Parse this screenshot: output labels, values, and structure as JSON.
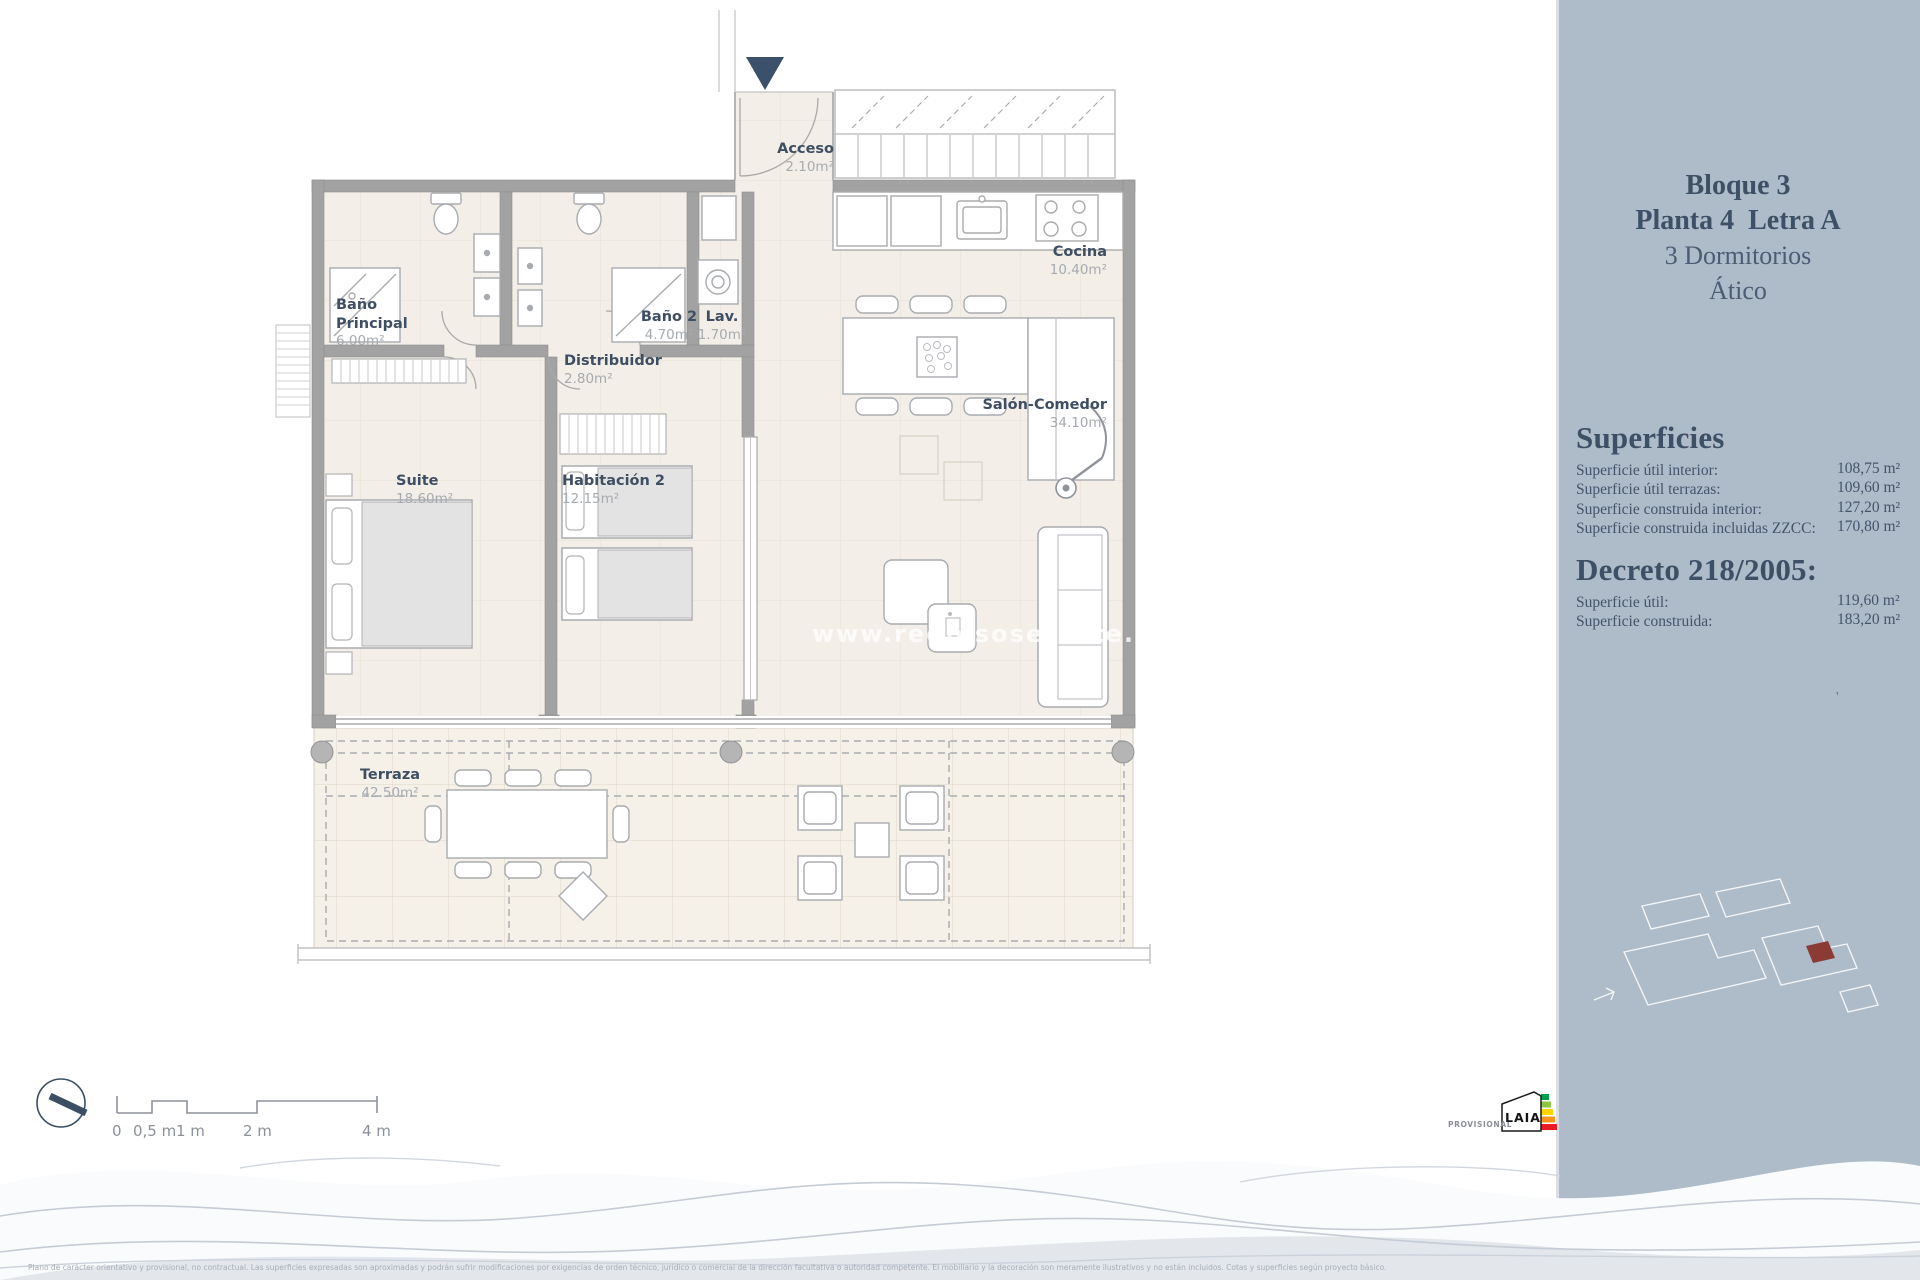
{
  "panel": {
    "line1": "Bloque 3",
    "line2": "Planta 4  Letra A",
    "line3": "3 Dormitorios",
    "line4": "Ático",
    "superficies_heading": "Superficies",
    "sup_rows": [
      {
        "label": "Superficie útil interior:",
        "value": "108,75 m²"
      },
      {
        "label": "Superficie útil terrazas:",
        "value": "109,60 m²"
      },
      {
        "label": "Superficie construida interior:",
        "value": "127,20 m²"
      },
      {
        "label": "Superficie construida incluidas ZZCC:",
        "value": "170,80 m²"
      }
    ],
    "decreto_heading": "Decreto 218/2005:",
    "dec_rows": [
      {
        "label": "Superficie útil:",
        "value": "119,60 m²"
      },
      {
        "label": "Superficie construida:",
        "value": "183,20 m²"
      }
    ],
    "stray_mark": "'"
  },
  "rooms": {
    "acceso": {
      "name": "Acceso",
      "area": "2.10m²"
    },
    "banyo_principal": {
      "name": "Baño Principal",
      "area": "6.00m²"
    },
    "banyo2": {
      "name": "Baño 2",
      "area": "4.70m²"
    },
    "lav": {
      "name": "Lav.",
      "area": "1.70m²"
    },
    "distribuidor": {
      "name": "Distribuidor",
      "area": "2.80m²"
    },
    "cocina": {
      "name": "Cocina",
      "area": "10.40m²"
    },
    "salon": {
      "name": "Salón-Comedor",
      "area": "34.10m²"
    },
    "suite": {
      "name": "Suite",
      "area": "18.60m²"
    },
    "habitacion2": {
      "name": "Habitación 2",
      "area": "12.15m²"
    },
    "terraza": {
      "name": "Terraza",
      "area": "42.50m²"
    }
  },
  "watermark": "www.redpisosestate.com",
  "scale": {
    "labels": [
      "0",
      "0,5 m",
      "1 m",
      "2 m",
      "4 m"
    ]
  },
  "footer": {
    "provisional": "PROVISIONAL",
    "logo_text": "LAIA",
    "disclaimer": "Plano de carácter orientativo y provisional, no contractual. Las superficies expresadas son aproximadas y podrán sufrir modificaciones por exigencias de orden técnico, jurídico o comercial de la dirección facultativa o autoridad competente. El mobiliario y la decoración son meramente ilustrativos y no están incluidos. Cotas y superficies según proyecto básico."
  },
  "colors": {
    "accent_navy": "#3a506b",
    "panel_bg": "#aebbc8",
    "red_marker": "#8a3c34"
  }
}
